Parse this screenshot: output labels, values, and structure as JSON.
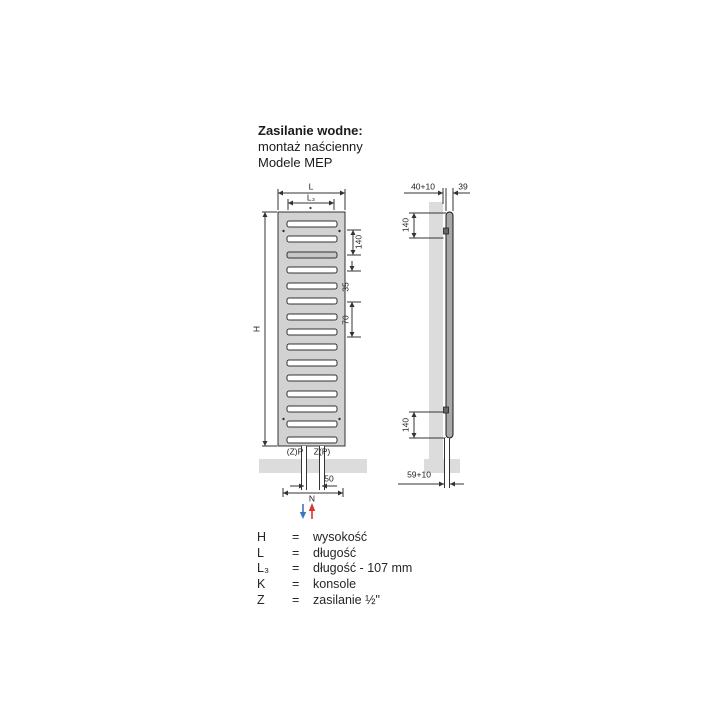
{
  "title": {
    "heading": "Zasilanie wodne:",
    "subline1": "montaż naścienny",
    "subline2": "Modele MEP"
  },
  "front_view": {
    "dim_length": "L",
    "dim_length3": "L₃",
    "dim_height": "H",
    "dim_top_offset": "140",
    "dim_slot_pitch": "35",
    "dim_slot_pitch2": "70",
    "pipe_left": "(Z)P",
    "pipe_right": "Z(P)",
    "dim_pipe_spacing": "50",
    "dim_console_spacing": "N"
  },
  "side_view": {
    "dim_wall_distance": "40+10",
    "dim_depth": "39",
    "dim_bracket_top": "140",
    "dim_bracket_bottom": "140",
    "dim_pipe_wall": "59+10"
  },
  "flow": {
    "return_color": "#3f74bf",
    "supply_color": "#d8342c"
  },
  "colors": {
    "line": "#333333",
    "body_fill": "#d2d2d2",
    "wall_fill": "#dcdcdc",
    "panel_fill": "#a8a8a8"
  },
  "legend": {
    "rows": [
      {
        "symbol": "H",
        "eq": "=",
        "desc": "wysokość"
      },
      {
        "symbol": "L",
        "eq": "=",
        "desc": "długość"
      },
      {
        "symbol": "L₃",
        "eq": "=",
        "desc": "długość - 107 mm"
      },
      {
        "symbol": "K",
        "eq": "=",
        "desc": "konsole"
      },
      {
        "symbol": "Z",
        "eq": "=",
        "desc": "zasilanie ½\""
      }
    ]
  }
}
